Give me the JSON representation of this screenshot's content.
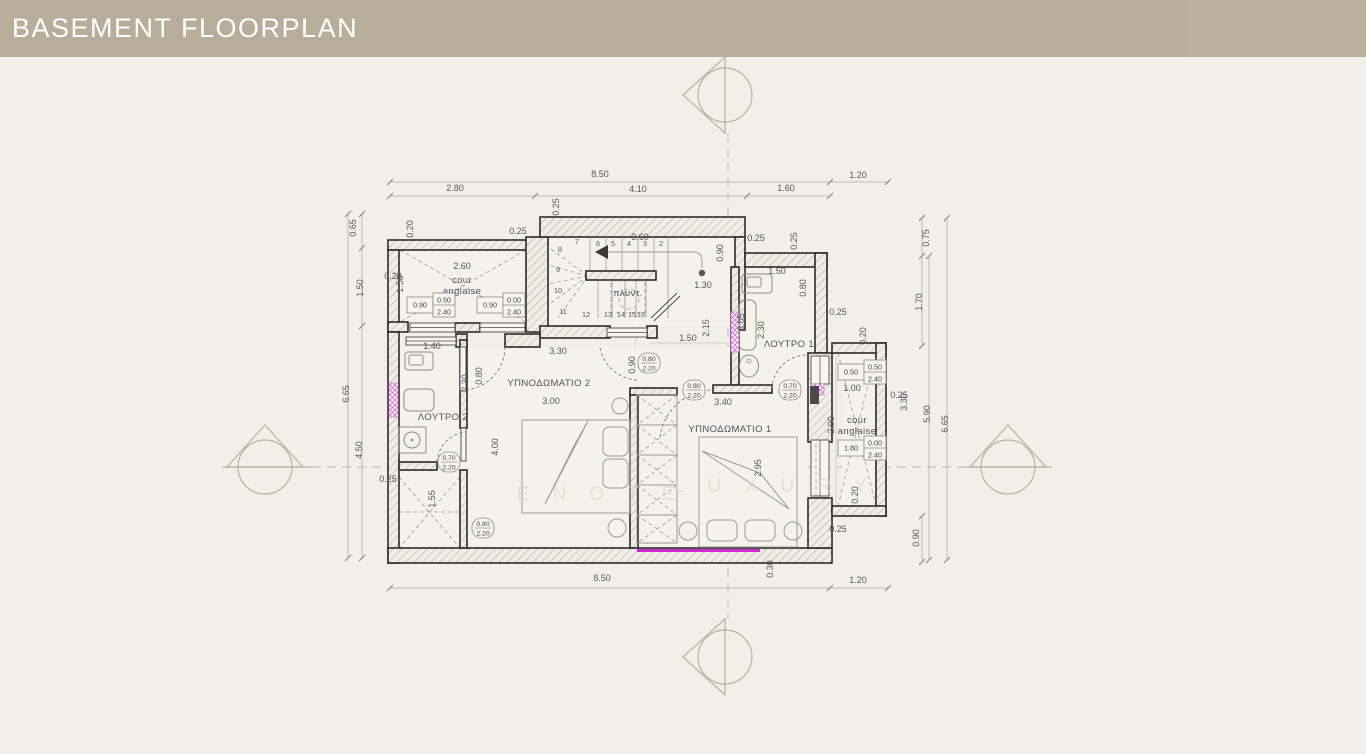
{
  "header": {
    "title": "BASEMENT FLOORPLAN",
    "bg": "#b7ad9a",
    "text_color": "#ffffff"
  },
  "page": {
    "bg": "#f2efe9"
  },
  "colors": {
    "wall_line": "#2b2b2b",
    "dim_text": "#55565c",
    "label_text": "#4b5260",
    "centerline": "#a0a7ce",
    "magenta_accent": "#cc2bcc",
    "pink_window": "#d966d9",
    "hatch": "#adaaa2",
    "watermark": "#d8d2c6"
  },
  "plan": {
    "rooms": [
      {
        "t": "ΥΠΝΟΔΩΜΑΤΙΟ 2",
        "x": 549,
        "y": 386
      },
      {
        "t": "ΥΠΝΟΔΩΜΑΤΙΟ 1",
        "x": 730,
        "y": 432
      },
      {
        "t": "ΛΟΥΤΡΟ 2",
        "x": 443,
        "y": 420
      },
      {
        "t": "ΛΟΥΤΡΟ 1",
        "x": 789,
        "y": 347
      },
      {
        "t": "πλυντ.",
        "x": 628,
        "y": 296
      },
      {
        "t": "cour",
        "x": 462,
        "y": 283
      },
      {
        "t": "anglaise",
        "x": 462,
        "y": 294
      },
      {
        "t": "cour",
        "x": 857,
        "y": 423
      },
      {
        "t": "anglaise",
        "x": 857,
        "y": 434
      }
    ],
    "dims_h": [
      {
        "t": "8.50",
        "x": 600,
        "y": 177
      },
      {
        "t": "2.80",
        "x": 455,
        "y": 191
      },
      {
        "t": "4.10",
        "x": 638,
        "y": 192
      },
      {
        "t": "1.60",
        "x": 786,
        "y": 191
      },
      {
        "t": "1.20",
        "x": 858,
        "y": 178
      },
      {
        "t": "8.50",
        "x": 602,
        "y": 581
      },
      {
        "t": "1.20",
        "x": 858,
        "y": 583
      },
      {
        "t": "0.25",
        "x": 518,
        "y": 234
      },
      {
        "t": "3.60",
        "x": 640,
        "y": 240
      },
      {
        "t": "0.25",
        "x": 756,
        "y": 241
      },
      {
        "t": "1.50",
        "x": 777,
        "y": 274
      },
      {
        "t": "1.30",
        "x": 703,
        "y": 288
      },
      {
        "t": "2.60",
        "x": 462,
        "y": 269
      },
      {
        "t": "0.20",
        "x": 393,
        "y": 279
      },
      {
        "t": "1.50",
        "x": 688,
        "y": 341
      },
      {
        "t": "0.25",
        "x": 838,
        "y": 315
      },
      {
        "t": "1.40",
        "x": 432,
        "y": 349
      },
      {
        "t": "3.30",
        "x": 558,
        "y": 354
      },
      {
        "t": "3.00",
        "x": 551,
        "y": 404
      },
      {
        "t": "3.40",
        "x": 723,
        "y": 405
      },
      {
        "t": "1.00",
        "x": 852,
        "y": 391
      },
      {
        "t": "0.25",
        "x": 899,
        "y": 398
      },
      {
        "t": "0.25",
        "x": 388,
        "y": 482
      },
      {
        "t": "0.25",
        "x": 838,
        "y": 532
      }
    ],
    "dims_v": [
      {
        "t": "0.65",
        "x": 356,
        "y": 228
      },
      {
        "t": "1.50",
        "x": 363,
        "y": 288
      },
      {
        "t": "6.65",
        "x": 349,
        "y": 394
      },
      {
        "t": "4.50",
        "x": 362,
        "y": 450
      },
      {
        "t": "0.20",
        "x": 413,
        "y": 229
      },
      {
        "t": "0.25",
        "x": 559,
        "y": 207
      },
      {
        "t": "0.90",
        "x": 723,
        "y": 253
      },
      {
        "t": "0.25",
        "x": 797,
        "y": 241
      },
      {
        "t": "0.80",
        "x": 806,
        "y": 288
      },
      {
        "t": "1.50",
        "x": 403,
        "y": 284
      },
      {
        "t": "2.30",
        "x": 468,
        "y": 383
      },
      {
        "t": "0.80",
        "x": 482,
        "y": 376
      },
      {
        "t": "2.30",
        "x": 764,
        "y": 330
      },
      {
        "t": "2.15",
        "x": 709,
        "y": 328
      },
      {
        "t": "3.05",
        "x": 744,
        "y": 322
      },
      {
        "t": "0.20",
        "x": 866,
        "y": 336
      },
      {
        "t": "0.90",
        "x": 635,
        "y": 365
      },
      {
        "t": "4.00",
        "x": 498,
        "y": 447
      },
      {
        "t": "1.55",
        "x": 435,
        "y": 499
      },
      {
        "t": "2.95",
        "x": 761,
        "y": 468
      },
      {
        "t": "2.90",
        "x": 834,
        "y": 425
      },
      {
        "t": "0.20",
        "x": 858,
        "y": 495
      },
      {
        "t": "3.30",
        "x": 907,
        "y": 402
      },
      {
        "t": "0.75",
        "x": 929,
        "y": 238
      },
      {
        "t": "1.70",
        "x": 922,
        "y": 302
      },
      {
        "t": "5.90",
        "x": 930,
        "y": 414
      },
      {
        "t": "6.65",
        "x": 948,
        "y": 424
      },
      {
        "t": "0.90",
        "x": 919,
        "y": 538
      },
      {
        "t": "0.30",
        "x": 773,
        "y": 569
      }
    ],
    "stair_numbers": [
      {
        "t": "2",
        "x": 661,
        "y": 246
      },
      {
        "t": "3",
        "x": 645,
        "y": 246
      },
      {
        "t": "4",
        "x": 629,
        "y": 246
      },
      {
        "t": "5",
        "x": 613,
        "y": 246
      },
      {
        "t": "6",
        "x": 598,
        "y": 246
      },
      {
        "t": "7",
        "x": 577,
        "y": 244
      },
      {
        "t": "8",
        "x": 560,
        "y": 252
      },
      {
        "t": "9",
        "x": 558,
        "y": 272
      },
      {
        "t": "10",
        "x": 558,
        "y": 293
      },
      {
        "t": "11",
        "x": 563,
        "y": 314
      },
      {
        "t": "12",
        "x": 586,
        "y": 317
      },
      {
        "t": "13",
        "x": 608,
        "y": 317
      },
      {
        "t": "14",
        "x": 621,
        "y": 317
      },
      {
        "t": "15",
        "x": 632,
        "y": 317
      },
      {
        "t": "16",
        "x": 641,
        "y": 317
      }
    ],
    "door_badges": [
      {
        "a": "0.80",
        "b": "2.20",
        "x": 649,
        "y": 363
      },
      {
        "a": "0.80",
        "b": "2.20",
        "x": 694,
        "y": 390
      },
      {
        "a": "0.70",
        "b": "2.20",
        "x": 790,
        "y": 390
      },
      {
        "a": "0.70",
        "b": "2.20",
        "x": 449,
        "y": 462
      },
      {
        "a": "0.80",
        "b": "2.20",
        "x": 483,
        "y": 528
      }
    ],
    "window_boxes": [
      {
        "w": "0.90",
        "s": "0.50",
        "h": "2.40",
        "x": 407,
        "y": 293
      },
      {
        "w": "0.90",
        "s": "0.00",
        "h": "2.40",
        "x": 477,
        "y": 293
      },
      {
        "w": "0.50",
        "s": "0.50",
        "h": "2.40",
        "x": 838,
        "y": 360
      },
      {
        "w": "1.80",
        "s": "0.00",
        "h": "2.40",
        "x": 838,
        "y": 436
      }
    ],
    "watermark": [
      {
        "t": "E N O T E",
        "x": 600,
        "y": 500
      },
      {
        "t": "L U X U R Y",
        "x": 775,
        "y": 492
      }
    ]
  }
}
